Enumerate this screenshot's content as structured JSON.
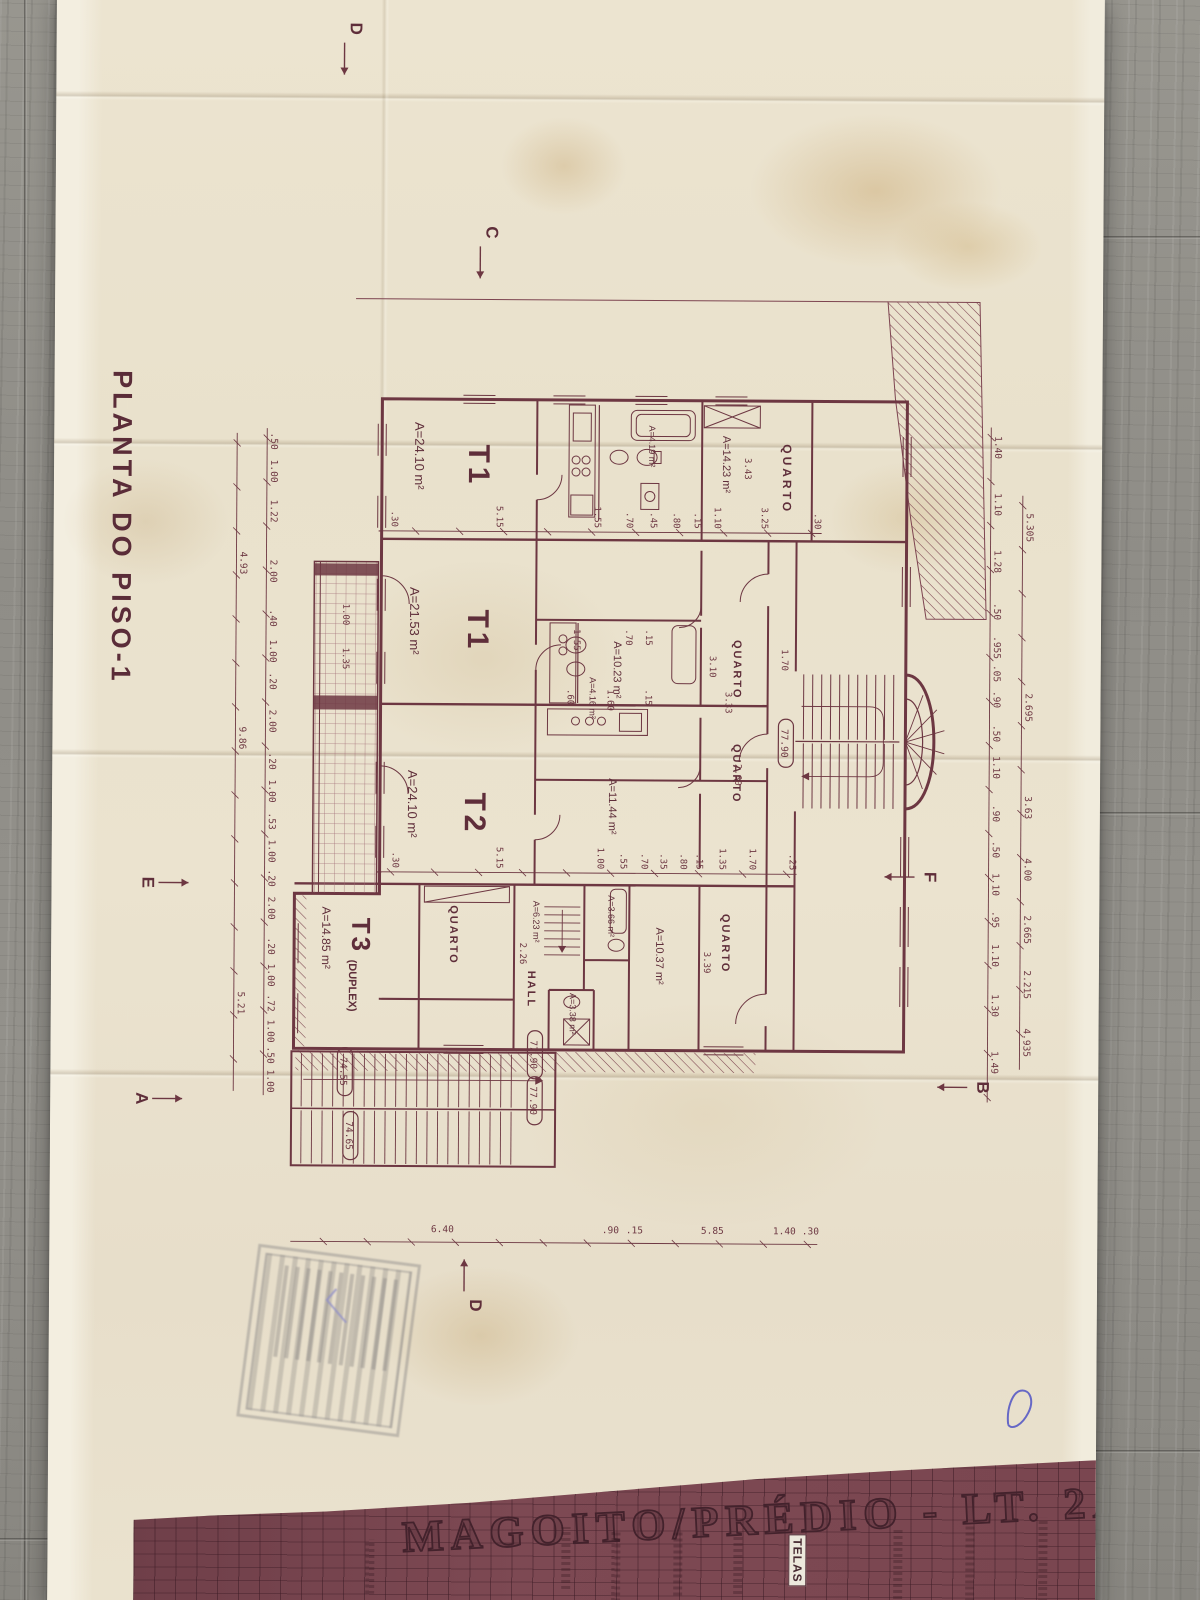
{
  "sheet": {
    "plan_title": "PLANTA DO PISO-1",
    "project_title": "MAGOITO/PRÉDIO - LT. 2A",
    "titleblock_label": "TELAS"
  },
  "plan": {
    "ink": "#6d3742",
    "rooms": [
      {
        "x": 440,
        "y": 578,
        "t": "T1",
        "s": 30,
        "b": 1,
        "sp": 4
      },
      {
        "x": 418,
        "y": 632,
        "t": "A=24.10 m²",
        "s": 13
      },
      {
        "x": 605,
        "y": 578,
        "t": "T1",
        "s": 30,
        "b": 1,
        "sp": 4
      },
      {
        "x": 583,
        "y": 636,
        "t": "A=21.53 m²",
        "s": 13
      },
      {
        "x": 788,
        "y": 580,
        "t": "T2",
        "s": 30,
        "b": 1,
        "sp": 4
      },
      {
        "x": 766,
        "y": 637,
        "t": "A=24.10 m²",
        "s": 13
      },
      {
        "x": 914,
        "y": 692,
        "t": "T3",
        "s": 26,
        "b": 1,
        "sp": 3
      },
      {
        "x": 956,
        "y": 695,
        "t": "(DUPLEX)",
        "s": 11,
        "b": 1
      },
      {
        "x": 903,
        "y": 722,
        "t": "A=14.85 m²",
        "s": 12
      },
      {
        "x": 438,
        "y": 264,
        "t": "QUARTO",
        "s": 12,
        "b": 1,
        "sp": 3
      },
      {
        "x": 430,
        "y": 324,
        "t": "A=14.23 m²",
        "s": 11
      },
      {
        "x": 634,
        "y": 312,
        "t": "QUARTO",
        "s": 11,
        "b": 1,
        "sp": 2
      },
      {
        "x": 636,
        "y": 432,
        "t": "A=10.23 m²",
        "s": 11
      },
      {
        "x": 738,
        "y": 312,
        "t": "QUARTO",
        "s": 11,
        "b": 1,
        "sp": 2
      },
      {
        "x": 773,
        "y": 436,
        "t": "A=11.44 m²",
        "s": 11
      },
      {
        "x": 908,
        "y": 322,
        "t": "QUARTO",
        "s": 11,
        "b": 1,
        "sp": 2
      },
      {
        "x": 922,
        "y": 388,
        "t": "A=10.37 m²",
        "s": 11
      },
      {
        "x": 890,
        "y": 436,
        "t": "A=3.66 m²",
        "s": 9
      },
      {
        "x": 988,
        "y": 474,
        "t": "A=3.38 m²",
        "s": 9
      },
      {
        "x": 966,
        "y": 516,
        "t": "HALL",
        "s": 11,
        "b": 1,
        "sp": 2
      },
      {
        "x": 896,
        "y": 511,
        "t": "A=6.23 m²",
        "s": 9
      },
      {
        "x": 901,
        "y": 594,
        "t": "QUARTO",
        "s": 11,
        "b": 1,
        "sp": 2
      },
      {
        "x": 420,
        "y": 398,
        "t": "A=4.19 m²",
        "s": 9
      },
      {
        "x": 672,
        "y": 456,
        "t": "A=4.16 m²",
        "s": 9
      }
    ],
    "free_dims": [
      {
        "x": 452,
        "y": 302,
        "v": "3.43"
      },
      {
        "x": 650,
        "y": 336,
        "v": "3.10"
      },
      {
        "x": 686,
        "y": 320,
        "v": "3.33"
      },
      {
        "x": 758,
        "y": 310,
        "v": "2.60"
      },
      {
        "x": 643,
        "y": 264,
        "v": "1.70"
      },
      {
        "x": 946,
        "y": 340,
        "v": "3.39"
      },
      {
        "x": 938,
        "y": 524,
        "v": "2.26"
      },
      {
        "x": 644,
        "y": 703,
        "v": "1.35"
      },
      {
        "x": 600,
        "y": 703,
        "v": "1.00"
      },
      {
        "x": 624,
        "y": 472,
        "v": "1.55"
      },
      {
        "x": 624,
        "y": 420,
        "v": ".70"
      },
      {
        "x": 624,
        "y": 400,
        "v": ".15"
      },
      {
        "x": 684,
        "y": 478,
        "v": ".60"
      },
      {
        "x": 684,
        "y": 438,
        "v": "1.60"
      },
      {
        "x": 684,
        "y": 400,
        "v": ".15"
      }
    ],
    "dim_rows": [
      {
        "dir": "h",
        "y": 20,
        "line": [
          488,
          1062
        ],
        "items": [
          {
            "x": 520,
            "v": "5.305"
          },
          {
            "x": 700,
            "v": "2.695"
          },
          {
            "x": 800,
            "v": "3.63"
          },
          {
            "x": 862,
            "v": "4.00"
          },
          {
            "x": 922,
            "v": "2.665"
          },
          {
            "x": 977,
            "v": "2.215"
          },
          {
            "x": 1035,
            "v": "4.935"
          }
        ]
      },
      {
        "dir": "h",
        "y": 52,
        "line": [
          420,
          1095
        ],
        "items": [
          {
            "x": 440,
            "v": "1.40"
          },
          {
            "x": 497,
            "v": "1.10"
          },
          {
            "x": 554,
            "v": "1.28"
          },
          {
            "x": 604,
            "v": ".50"
          },
          {
            "x": 640,
            "v": ".955"
          },
          {
            "x": 666,
            "v": ".05"
          },
          {
            "x": 692,
            "v": ".90"
          },
          {
            "x": 726,
            "v": ".50"
          },
          {
            "x": 760,
            "v": "1.10"
          },
          {
            "x": 806,
            "v": ".90"
          },
          {
            "x": 842,
            "v": ".50"
          },
          {
            "x": 877,
            "v": "1.10"
          },
          {
            "x": 912,
            "v": ".95"
          },
          {
            "x": 948,
            "v": "1.10"
          },
          {
            "x": 998,
            "v": "1.30"
          },
          {
            "x": 1055,
            "v": "1.49"
          }
        ]
      },
      {
        "dir": "h",
        "y": 776,
        "line": [
          425,
          1092
        ],
        "items": [
          {
            "x": 438,
            "v": ".50"
          },
          {
            "x": 468,
            "v": "1.00"
          },
          {
            "x": 508,
            "v": "1.22"
          },
          {
            "x": 568,
            "v": "2.00"
          },
          {
            "x": 615,
            "v": ".40"
          },
          {
            "x": 648,
            "v": "1.00"
          },
          {
            "x": 678,
            "v": ".20"
          },
          {
            "x": 718,
            "v": "2.00"
          },
          {
            "x": 758,
            "v": ".20"
          },
          {
            "x": 788,
            "v": "1.00"
          },
          {
            "x": 818,
            "v": ".53"
          },
          {
            "x": 848,
            "v": "1.00"
          },
          {
            "x": 875,
            "v": ".20"
          },
          {
            "x": 905,
            "v": "2.00"
          },
          {
            "x": 943,
            "v": ".20"
          },
          {
            "x": 972,
            "v": "1.00"
          },
          {
            "x": 1000,
            "v": ".72"
          },
          {
            "x": 1028,
            "v": "1.00"
          },
          {
            "x": 1052,
            "v": ".50"
          },
          {
            "x": 1078,
            "v": "1.00"
          }
        ]
      },
      {
        "dir": "h",
        "y": 806,
        "line": [
          430,
          1088
        ],
        "items": [
          {
            "x": 560,
            "v": "4.93"
          },
          {
            "x": 735,
            "v": "9.86"
          },
          {
            "x": 1000,
            "v": "5.21"
          }
        ]
      },
      {
        "dir": "v",
        "x": 521,
        "line": [
          225,
          668
        ],
        "items": [
          {
            "y": 655,
            "v": ".30"
          },
          {
            "y": 550,
            "v": "5.15"
          },
          {
            "y": 452,
            "v": "1.55"
          },
          {
            "y": 420,
            "v": ".70"
          },
          {
            "y": 396,
            "v": ".45"
          },
          {
            "y": 373,
            "v": ".80"
          },
          {
            "y": 352,
            "v": ".15"
          },
          {
            "y": 332,
            "v": "1.10"
          },
          {
            "y": 285,
            "v": "3.25"
          },
          {
            "y": 232,
            "v": ".30"
          }
        ]
      },
      {
        "dir": "v",
        "x": 862,
        "line": [
          248,
          668
        ],
        "items": [
          {
            "y": 652,
            "v": ".30"
          },
          {
            "y": 548,
            "v": "5.15"
          },
          {
            "y": 447,
            "v": "1.00"
          },
          {
            "y": 424,
            "v": ".55"
          },
          {
            "y": 403,
            "v": ".70"
          },
          {
            "y": 384,
            "v": ".35"
          },
          {
            "y": 364,
            "v": ".80"
          },
          {
            "y": 348,
            "v": ".15"
          },
          {
            "y": 325,
            "v": "1.35"
          },
          {
            "y": 295,
            "v": "1.70"
          },
          {
            "y": 255,
            "v": ".25"
          }
        ]
      },
      {
        "dir": "vr",
        "x": 1232,
        "line": [
          225,
          752
        ],
        "items": [
          {
            "y": 600,
            "v": "6.40"
          },
          {
            "y": 432,
            "v": ".90"
          },
          {
            "y": 408,
            "v": ".15"
          },
          {
            "y": 330,
            "v": "5.85"
          },
          {
            "y": 258,
            "v": "1.40"
          },
          {
            "y": 232,
            "v": ".30"
          }
        ]
      }
    ],
    "levels": [
      {
        "x": 737,
        "y": 263,
        "v": "77.90"
      },
      {
        "x": 1050,
        "y": 512,
        "v": "77.90"
      },
      {
        "x": 1096,
        "y": 512,
        "v": "77.90"
      },
      {
        "x": 1068,
        "y": 702,
        "v": "74.55"
      },
      {
        "x": 1132,
        "y": 696,
        "v": "74.65"
      }
    ],
    "sections": [
      {
        "x": 228,
        "y": 562,
        "v": "C",
        "dir": "r"
      },
      {
        "x": 25,
        "y": 699,
        "v": "D",
        "dir": "r"
      },
      {
        "x": 1301,
        "y": 572,
        "v": "D",
        "dir": "l"
      },
      {
        "x": 880,
        "y": 902,
        "v": "E",
        "dir": "u"
      },
      {
        "x": 870,
        "y": 120,
        "v": "F",
        "dir": "d"
      },
      {
        "x": 1096,
        "y": 907,
        "v": "A",
        "dir": "u"
      },
      {
        "x": 1080,
        "y": 66,
        "v": "B",
        "dir": "d"
      }
    ]
  }
}
